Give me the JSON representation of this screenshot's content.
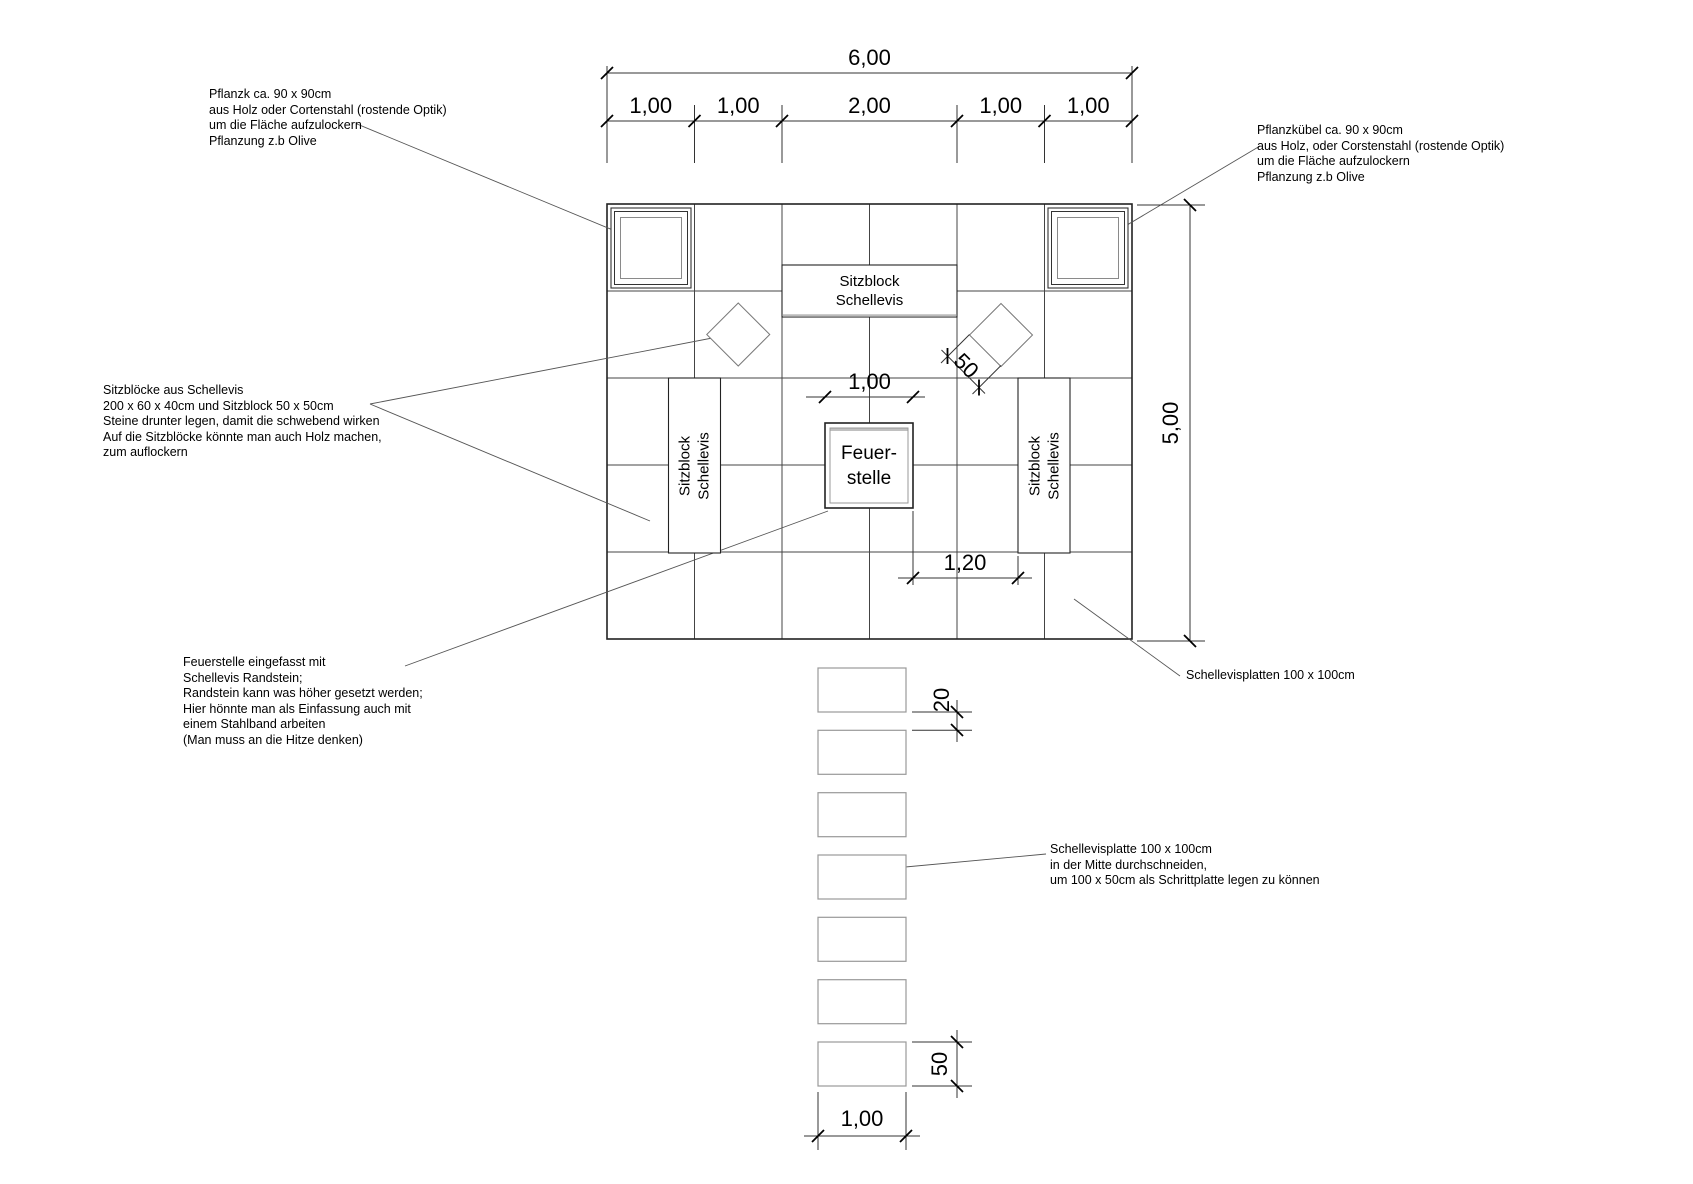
{
  "dims": {
    "top_total": "6,00",
    "top_segments": [
      "1,00",
      "1,00",
      "2,00",
      "1,00",
      "1,00"
    ],
    "right_height": "5,00",
    "feuerstelle_width": "1,00",
    "feuerstelle_to_block": "1,20",
    "diamond_block": "50",
    "path_gap": "20",
    "path_plate": "50",
    "path_width": "1,00"
  },
  "blocks": {
    "seat_horizontal": [
      "Sitzblock",
      "Schellevis"
    ],
    "seat_left": [
      "Sitzblock",
      "Schellevis"
    ],
    "seat_right": [
      "Sitzblock",
      "Schellevis"
    ],
    "feuerstelle": [
      "Feuer-",
      "stelle"
    ]
  },
  "annotations": {
    "planter_left": [
      "Pflanzk ca. 90 x 90cm",
      "aus Holz oder Cortenstahl (rostende Optik)",
      "um die Fläche aufzulockern",
      "Pflanzung z.b Olive"
    ],
    "planter_right": [
      "Pflanzkübel ca. 90 x 90cm",
      "aus Holz, oder Corstenstahl (rostende Optik)",
      "um die Fläche aufzulockern",
      "Pflanzung z.b Olive"
    ],
    "seat_blocks": [
      "Sitzblöcke aus Schellevis",
      "200 x 60 x 40cm und Sitzblock 50 x 50cm",
      "Steine drunter legen, damit die schwebend wirken",
      "Auf die Sitzblöcke könnte man auch Holz machen,",
      "zum auflockern"
    ],
    "feuerstelle": [
      "Feuerstelle eingefasst mit",
      "Schellevis Randstein;",
      "Randstein kann was höher gesetzt werden;",
      "Hier hönnte man als Einfassung auch mit",
      "einem Stahlband arbeiten",
      "(Man muss an die Hitze denken)"
    ],
    "plates": "Schellevisplatten 100 x 100cm",
    "step_plate": [
      "Schellevisplatte 100 x 100cm",
      "in der Mitte durchschneiden,",
      "um 100 x 50cm als Schrittplatte legen zu können"
    ]
  },
  "colors": {
    "line_dark": "#222222",
    "line_grid": "#444444",
    "line_light": "#999999",
    "background": "#ffffff"
  }
}
